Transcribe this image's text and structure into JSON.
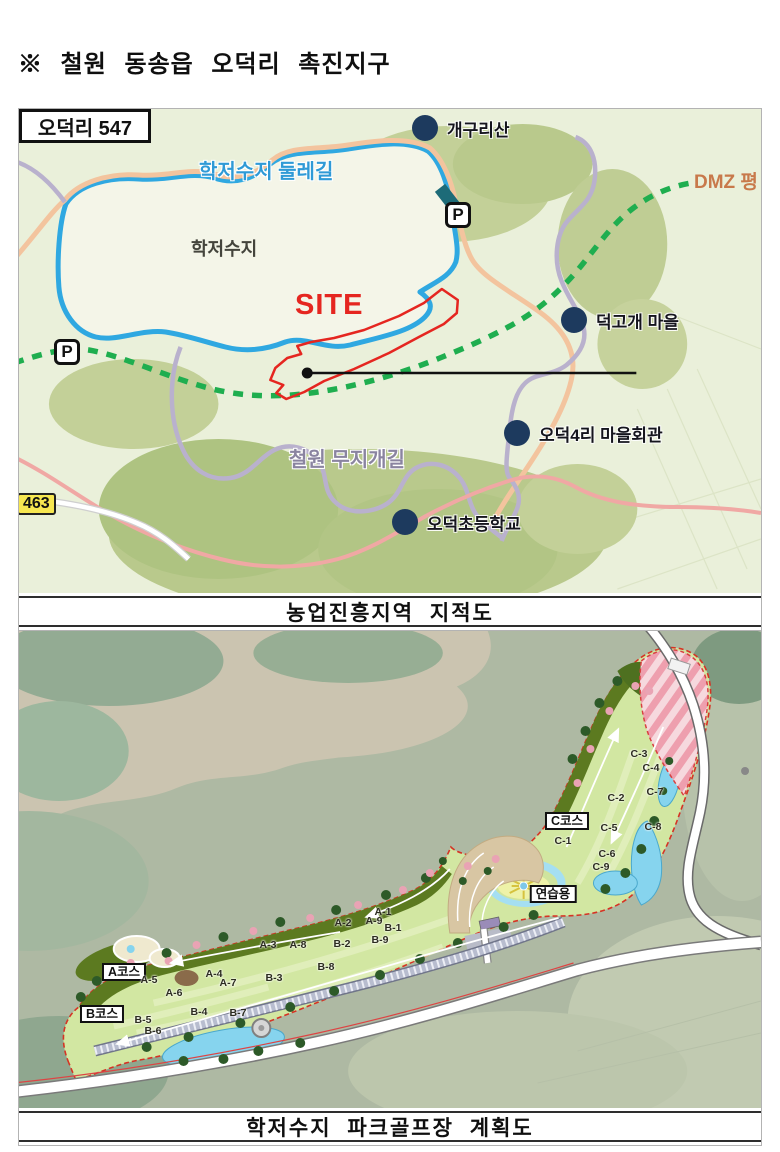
{
  "header": {
    "title": "※ 철원 동송읍 오덕리 촉진지구"
  },
  "map1": {
    "caption": "농업진흥지역 지적도",
    "labels": {
      "trail": "학저수지 둘레길",
      "lake": "학저수지",
      "site": "SITE",
      "dmz": "DMZ 평",
      "rainbow_trail": "철원 무지개길",
      "road_badge": "463",
      "callout": "오덕리 547"
    },
    "parking_symbol": "P",
    "parkings": [
      {
        "x": 439,
        "y": 106
      },
      {
        "x": 48,
        "y": 243
      }
    ],
    "pois": [
      {
        "label": "개구리산",
        "x": 406,
        "y": 19
      },
      {
        "label": "덕고개 마을",
        "x": 555,
        "y": 211
      },
      {
        "label": "오덕4리 마을회관",
        "x": 498,
        "y": 324
      },
      {
        "label": "오덕초등학교",
        "x": 386,
        "y": 413
      }
    ]
  },
  "map2": {
    "caption": "학저수지 파크골프장 계획도",
    "course_boxes": [
      {
        "label": "A코스",
        "x": 105,
        "y": 341
      },
      {
        "label": "B코스",
        "x": 83,
        "y": 383
      },
      {
        "label": "C코스",
        "x": 548,
        "y": 190
      },
      {
        "label": "연습용",
        "x": 534,
        "y": 263
      }
    ],
    "holes": [
      {
        "label": "A-1",
        "x": 364,
        "y": 281
      },
      {
        "label": "A-2",
        "x": 324,
        "y": 292
      },
      {
        "label": "A-3",
        "x": 249,
        "y": 314
      },
      {
        "label": "A-4",
        "x": 195,
        "y": 343
      },
      {
        "label": "A-5",
        "x": 130,
        "y": 349
      },
      {
        "label": "A-6",
        "x": 155,
        "y": 362
      },
      {
        "label": "A-7",
        "x": 209,
        "y": 352
      },
      {
        "label": "A-8",
        "x": 279,
        "y": 314
      },
      {
        "label": "A-9",
        "x": 355,
        "y": 290
      },
      {
        "label": "B-1",
        "x": 374,
        "y": 297
      },
      {
        "label": "B-2",
        "x": 323,
        "y": 313
      },
      {
        "label": "B-3",
        "x": 255,
        "y": 347
      },
      {
        "label": "B-4",
        "x": 180,
        "y": 381
      },
      {
        "label": "B-5",
        "x": 124,
        "y": 389
      },
      {
        "label": "B-6",
        "x": 134,
        "y": 400
      },
      {
        "label": "B-7",
        "x": 219,
        "y": 382
      },
      {
        "label": "B-8",
        "x": 307,
        "y": 336
      },
      {
        "label": "B-9",
        "x": 361,
        "y": 309
      },
      {
        "label": "C-1",
        "x": 544,
        "y": 210
      },
      {
        "label": "C-2",
        "x": 597,
        "y": 167
      },
      {
        "label": "C-3",
        "x": 620,
        "y": 123
      },
      {
        "label": "C-4",
        "x": 632,
        "y": 137
      },
      {
        "label": "C-5",
        "x": 590,
        "y": 197
      },
      {
        "label": "C-6",
        "x": 588,
        "y": 223
      },
      {
        "label": "C-7",
        "x": 636,
        "y": 161
      },
      {
        "label": "C-8",
        "x": 634,
        "y": 196
      },
      {
        "label": "C-9",
        "x": 582,
        "y": 236
      }
    ]
  },
  "colors": {
    "site_red": "#e52620",
    "lake_outline_blue": "#2fa8e1",
    "dmz_dash_green": "#1fae4f",
    "poi_navy": "#1d3a5e",
    "road_badge_yellow": "#f7e751",
    "course_green": "#d2e7a2",
    "water_blue": "#86d4ee"
  }
}
